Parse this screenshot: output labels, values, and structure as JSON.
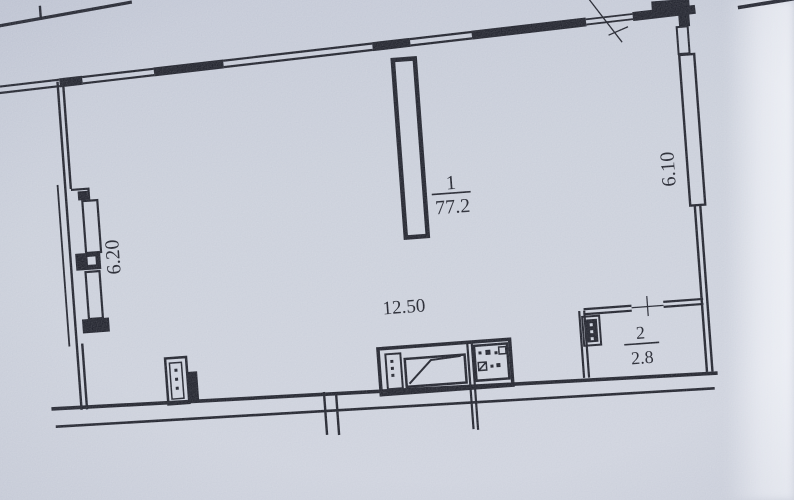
{
  "document": {
    "colors": {
      "paper": "#c9ced9",
      "ink": "#1a1c26",
      "edge_light": "#eef0f6"
    }
  },
  "rooms": [
    {
      "number": "1",
      "area": "77.2"
    },
    {
      "number": "2",
      "area": "2.8"
    }
  ],
  "dimensions": {
    "horizontal_length": "12.50",
    "left_side": "6.20",
    "right_side": "6.10"
  }
}
